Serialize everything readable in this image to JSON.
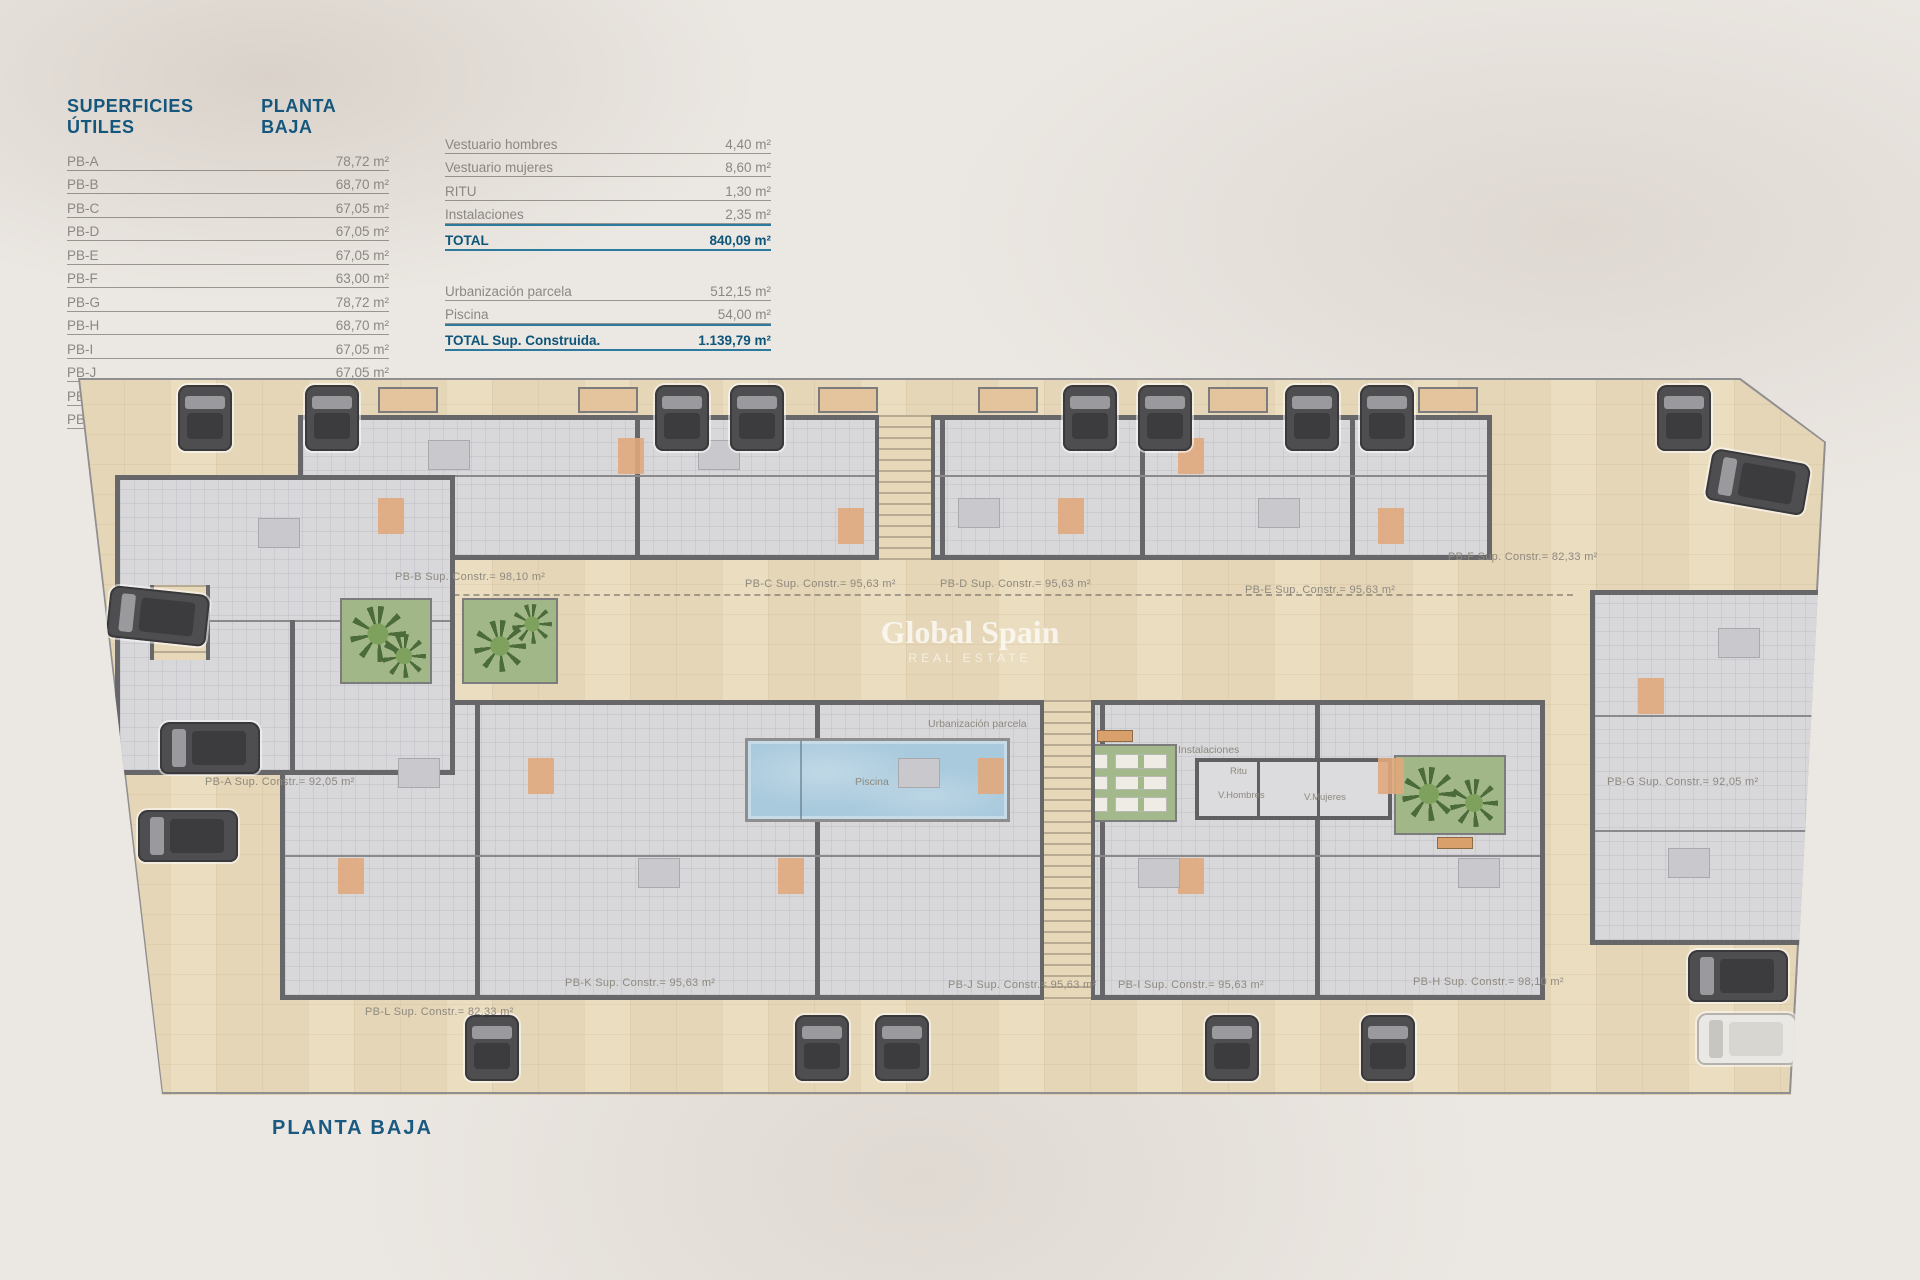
{
  "page": {
    "plan_title": "PLANTA BAJA"
  },
  "superficies": {
    "title": "SUPERFICIES ÚTILES",
    "subtitle": "PLANTA BAJA",
    "rows": [
      {
        "label": "PB-A",
        "value": "78,72 m²"
      },
      {
        "label": "PB-B",
        "value": "68,70 m²"
      },
      {
        "label": "PB-C",
        "value": "67,05 m²"
      },
      {
        "label": "PB-D",
        "value": "67,05 m²"
      },
      {
        "label": "PB-E",
        "value": "67,05 m²"
      },
      {
        "label": "PB-F",
        "value": "63,00 m²"
      },
      {
        "label": "PB-G",
        "value": "78,72 m²"
      },
      {
        "label": "PB-H",
        "value": "68,70 m²"
      },
      {
        "label": "PB-I",
        "value": "67,05 m²"
      },
      {
        "label": "PB-J",
        "value": "67,05 m²"
      },
      {
        "label": "PB-K",
        "value": "67,05 m²"
      },
      {
        "label": "PB-L",
        "value": "63,30 m²"
      }
    ]
  },
  "resumen": {
    "rows_a": [
      {
        "label": "Vestuario hombres",
        "value": "4,40 m²"
      },
      {
        "label": "Vestuario mujeres",
        "value": "8,60 m²"
      },
      {
        "label": "RITU",
        "value": "1,30 m²"
      },
      {
        "label": "Instalaciones",
        "value": "2,35 m²"
      }
    ],
    "total_a": {
      "label": "TOTAL",
      "value": "840,09 m²"
    },
    "rows_b": [
      {
        "label": "Urbanización parcela",
        "value": "512,15 m²"
      },
      {
        "label": "Piscina",
        "value": "54,00 m²"
      }
    ],
    "total_b": {
      "label": "TOTAL Sup. Construida.",
      "value": "1.139,79 m²"
    }
  },
  "plan": {
    "watermark": {
      "line1": "Global Spain",
      "line2": "REAL ESTATE"
    },
    "labels": {
      "urbanizacion": "Urbanización parcela",
      "piscina": "Piscina",
      "instalaciones": "Instalaciones",
      "ritu": "Ritu",
      "v_hombres": "V.Hombres",
      "v_mujeres": "V.Mujeres"
    },
    "units": [
      {
        "id": "PB-A",
        "label": "PB-A Sup. Constr.= 92,05 m²"
      },
      {
        "id": "PB-B",
        "label": "PB-B Sup. Constr.= 98,10 m²"
      },
      {
        "id": "PB-C",
        "label": "PB-C Sup. Constr.= 95,63 m²"
      },
      {
        "id": "PB-D",
        "label": "PB-D Sup. Constr.= 95,63 m²"
      },
      {
        "id": "PB-E",
        "label": "PB-E Sup. Constr.= 95,63 m²"
      },
      {
        "id": "PB-F",
        "label": "PB-F Sup. Constr.= 82,33 m²"
      },
      {
        "id": "PB-G",
        "label": "PB-G Sup. Constr.= 92,05 m²"
      },
      {
        "id": "PB-H",
        "label": "PB-H Sup. Constr.= 98,10 m²"
      },
      {
        "id": "PB-I",
        "label": "PB-I Sup. Constr.= 95,63 m²"
      },
      {
        "id": "PB-J",
        "label": "PB-J Sup. Constr.= 95,63 m²"
      },
      {
        "id": "PB-K",
        "label": "PB-K Sup. Constr.= 95,63 m²"
      },
      {
        "id": "PB-L",
        "label": "PB-L Sup. Constr.= 82,33 m²"
      }
    ]
  },
  "colors": {
    "accent_blue": "#15567d",
    "total_blue": "#0d5579",
    "rule_blue": "#2e7a9e",
    "text_gray": "#8b8783",
    "parcel_beige": "#e5d6b7",
    "unit_gray": "#d8d8db",
    "wall_gray": "#67676a",
    "pool_blue": "#a9cadd",
    "garden_green": "#a2b788",
    "accent_orange": "#e0a87c"
  },
  "icons": {
    "car": "car-icon",
    "palm": "palm-tree-icon",
    "sunbed": "sunbed-icon",
    "stairs": "stairs-icon"
  }
}
